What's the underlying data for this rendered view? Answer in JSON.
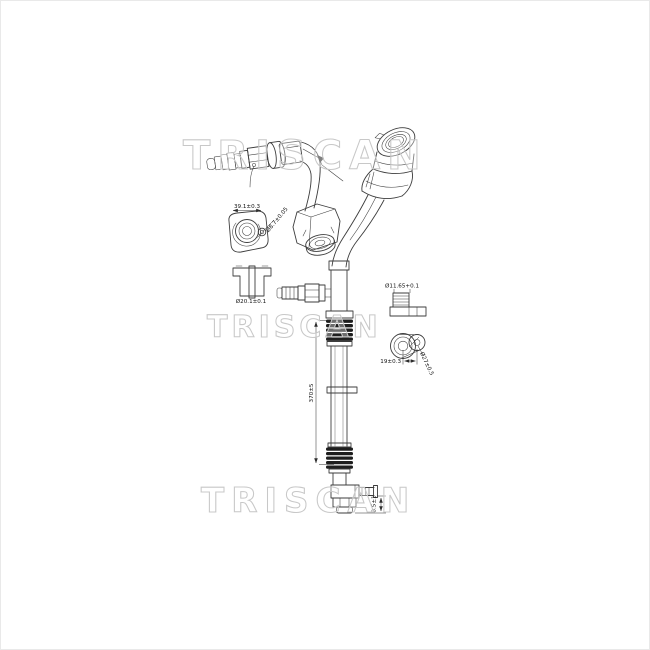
{
  "page": {
    "background": "#ffffff",
    "border_color": "#e9e9e9"
  },
  "watermarks": {
    "color": "#c8c8c8",
    "text_top": "TRISCAN",
    "text_middle": "TRISCAN",
    "text_bottom": "TRISCAN"
  },
  "drawing": {
    "line_color": "#3d3d3d",
    "dimensions": {
      "flange_width": "39.1±0.3",
      "flange_hole_dia": "Ø8.7±0.05",
      "section_bore_dia": "Ø20.1±0.1",
      "valve_port_dia": "Ø11.65+0.1",
      "eyelet_spacing": "19±0.3",
      "eyelet_outer_dia": "Ø27±0.5",
      "hose_length": "370±5",
      "outlet_offset": "8.5±1"
    }
  }
}
